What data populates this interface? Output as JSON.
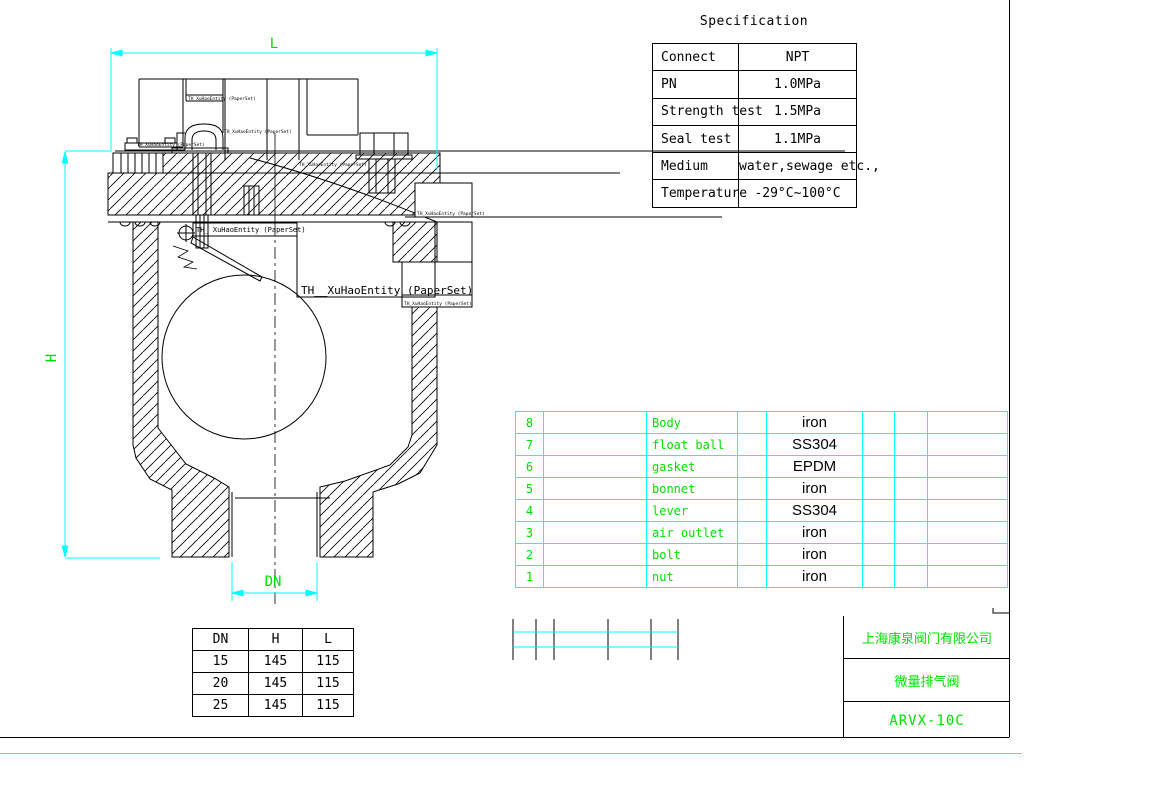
{
  "colors": {
    "dimension": "#00ffff",
    "label_green": "#00e000",
    "line": "#000000"
  },
  "drawing": {
    "dim_length_label": "L",
    "dim_height_label": "H",
    "dim_bore_label": "DN",
    "annotations": {
      "large": "TH__XuHaoEntity (PaperSet)",
      "small": "TH_ XuHaoEntity (PaperSet)",
      "tiny": "TH_XuHaoEntity (PaperSet)"
    }
  },
  "spec_table": {
    "title": "Specification",
    "rows": [
      [
        "Connect",
        "NPT"
      ],
      [
        "PN",
        "1.0MPa"
      ],
      [
        "Strength test",
        "1.5MPa"
      ],
      [
        "Seal test",
        "1.1MPa"
      ],
      [
        "Medium",
        "water,sewage etc.,"
      ],
      [
        "Temperature",
        "-29°C~100°C"
      ]
    ]
  },
  "parts_table": {
    "rows": [
      {
        "no": "8",
        "name": "Body",
        "material": "iron"
      },
      {
        "no": "7",
        "name": "float ball",
        "material": "SS304"
      },
      {
        "no": "6",
        "name": "gasket",
        "material": "EPDM"
      },
      {
        "no": "5",
        "name": "bonnet",
        "material": "iron"
      },
      {
        "no": "4",
        "name": "lever",
        "material": "SS304"
      },
      {
        "no": "3",
        "name": "air outlet",
        "material": "iron"
      },
      {
        "no": "2",
        "name": "bolt",
        "material": "iron"
      },
      {
        "no": "1",
        "name": "nut",
        "material": "iron"
      }
    ]
  },
  "size_table": {
    "headers": [
      "DN",
      "H",
      "L"
    ],
    "rows": [
      [
        "15",
        "145",
        "115"
      ],
      [
        "20",
        "145",
        "115"
      ],
      [
        "25",
        "145",
        "115"
      ]
    ]
  },
  "title_block": {
    "company": "上海康泉阀门有限公司",
    "product": "微量排气阀",
    "model": "ARVX-10C"
  }
}
